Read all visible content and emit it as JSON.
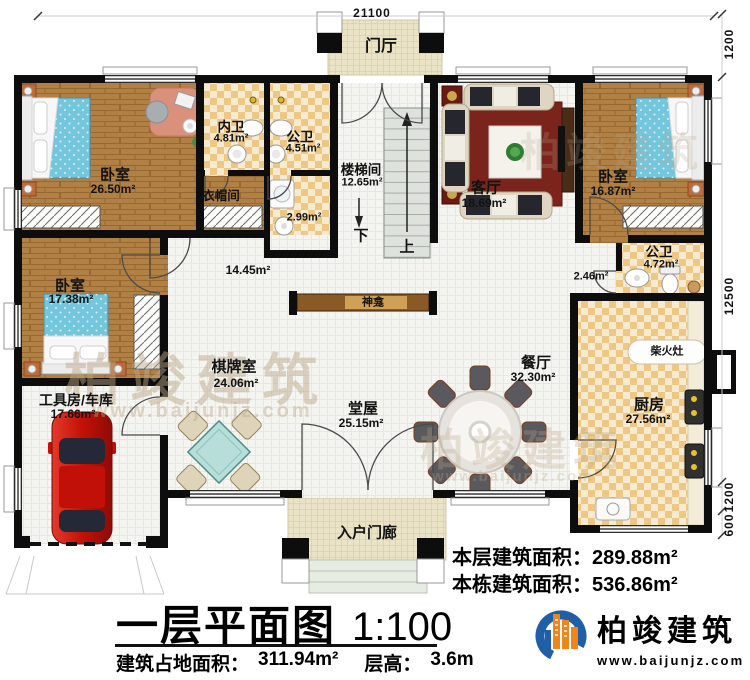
{
  "dims": {
    "top": "21100",
    "right": [
      "1200",
      "12500",
      "1200",
      "600"
    ]
  },
  "rooms": {
    "foyer": {
      "name": "门厅"
    },
    "bedroom1": {
      "name": "卧室",
      "area": "26.50m²"
    },
    "inner_bath": {
      "name": "内卫",
      "area": "4.81m²"
    },
    "public_bath_top": {
      "name": "公卫",
      "area": "4.51m²"
    },
    "cloakroom": {
      "name": "衣帽间"
    },
    "utility": {
      "area": "2.99m²"
    },
    "stairwell": {
      "name": "楼梯间",
      "area": "12.65m²"
    },
    "living": {
      "name": "客厅",
      "area": "18.69m²"
    },
    "bedroom2": {
      "name": "卧室",
      "area": "16.87m²"
    },
    "public_bath_mid": {
      "name": "公卫",
      "area": "4.72m²"
    },
    "corridor": {
      "area": "2.46m²"
    },
    "center_hall": {
      "area": "14.45m²"
    },
    "dining": {
      "name": "餐厅",
      "area": "32.30m²"
    },
    "main_hall": {
      "name": "堂屋",
      "area": "25.15m²"
    },
    "game_room": {
      "name": "棋牌室",
      "area": "24.06m²"
    },
    "bedroom3": {
      "name": "卧室",
      "area": "17.38m²"
    },
    "garage": {
      "name": "工具房/车库",
      "area": "17.66m²"
    },
    "kitchen": {
      "name": "厨房",
      "area": "27.56m²"
    },
    "entry_porch": {
      "name": "入户门廊"
    }
  },
  "features": {
    "shrine": "神龛",
    "wood_stove": "柴火灶",
    "stair_down": "下",
    "stair_up": "上"
  },
  "footer": {
    "title": "一层平面图",
    "scale": "1:100",
    "footprint_label": "建筑占地面积：",
    "footprint_value": "311.94m²",
    "floor_height_label": "层高：",
    "floor_height_value": "3.6m",
    "floor_area_label": "本层建筑面积：",
    "floor_area_value": "289.88m²",
    "building_area_label": "本栋建筑面积：",
    "building_area_value": "536.86m²",
    "brand": "柏竣建筑",
    "website": "www.baijunjz.com"
  },
  "watermark": {
    "brand": "柏竣建筑",
    "site": "www.baijunjz.com"
  },
  "colors": {
    "wall": "#0d0d0d",
    "tile": "#ecc884",
    "wood": "#b08045",
    "accent_blue": "#1f5fa8",
    "accent_orange": "#f08519"
  }
}
